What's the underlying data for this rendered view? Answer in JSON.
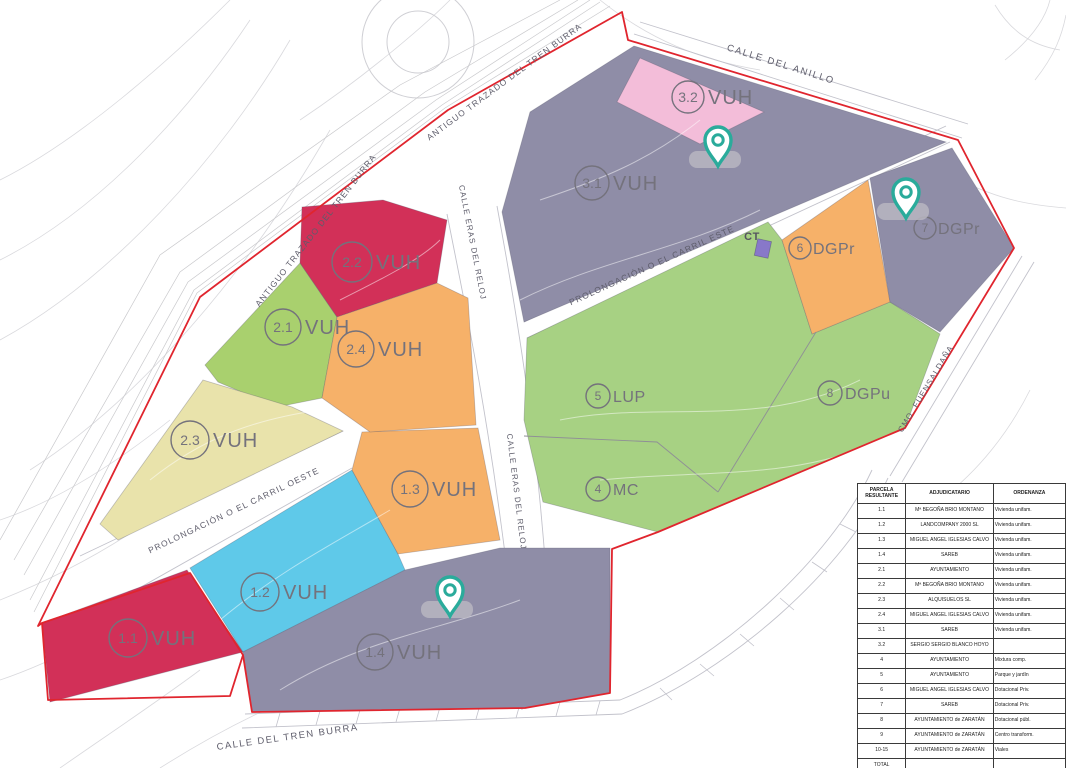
{
  "map": {
    "boundary_color": "#e0252e",
    "pin_color": "#2aab9b",
    "street_labels": [
      {
        "text": "ANTIGUO TRAZADO DEL TREN BURRA"
      },
      {
        "text": "ANTIGUO TRAZADO DEL TREN BURRA"
      },
      {
        "text": "CALLE DEL ANILLO"
      },
      {
        "text": "CALLE ERAS DEL RELOJ"
      },
      {
        "text": "CALLE ERAS DEL RELOJ"
      },
      {
        "text": "PROLONGACIÓN O EL CARRIL ESTE"
      },
      {
        "text": "PROLONGACIÓN O EL CARRIL OESTE"
      },
      {
        "text": "CALLE DEL TREN BURRA"
      },
      {
        "text": "CMO. FUENSALDAÑA"
      }
    ],
    "transformer_label": "CT",
    "parcels": [
      {
        "number": "1.1",
        "use": "VUH",
        "color": "#d23058"
      },
      {
        "number": "1.2",
        "use": "VUH",
        "color": "#5fc9e9"
      },
      {
        "number": "1.3",
        "use": "VUH",
        "color": "#f6b169"
      },
      {
        "number": "1.4",
        "use": "VUH",
        "color": "#8f8da7"
      },
      {
        "number": "2.1",
        "use": "VUH",
        "color": "#a9d06e"
      },
      {
        "number": "2.2",
        "use": "VUH",
        "color": "#d23058"
      },
      {
        "number": "2.3",
        "use": "VUH",
        "color": "#e9e3ab"
      },
      {
        "number": "2.4",
        "use": "VUH",
        "color": "#f6b169"
      },
      {
        "number": "3.1",
        "use": "VUH",
        "color": "#8f8da7"
      },
      {
        "number": "3.2",
        "use": "VUH",
        "color": "#f3bdd9"
      },
      {
        "number": "4",
        "use": "MC",
        "color": "#a7d183"
      },
      {
        "number": "5",
        "use": "LUP",
        "color": "#a7d183"
      },
      {
        "number": "6",
        "use": "DGPr",
        "color": "#f6b169"
      },
      {
        "number": "7",
        "use": "DGPr",
        "color": "#8f8da7"
      },
      {
        "number": "8",
        "use": "DGPu",
        "color": "#a7d183"
      },
      {
        "number": "9",
        "use": "CT",
        "color": "#8878c9"
      }
    ]
  },
  "table": {
    "headers": [
      "PARCELA RESULTANTE",
      "ADJUDICATARIO",
      "ORDENANZA"
    ],
    "rows": [
      {
        "parcela": "1.1",
        "adjudicatario": "Mª BEGOÑA BRIO MONTANO",
        "ordenanza": "Vivienda unifam."
      },
      {
        "parcela": "1.2",
        "adjudicatario": "LANDCOMPANY 2000 SL",
        "ordenanza": "Vivienda unifam."
      },
      {
        "parcela": "1.3",
        "adjudicatario": "MIGUEL ANGEL IGLESIAS CALVO",
        "ordenanza": "Vivienda unifam."
      },
      {
        "parcela": "1.4",
        "adjudicatario": "SAREB",
        "ordenanza": "Vivienda unifam."
      },
      {
        "parcela": "2.1",
        "adjudicatario": "AYUNTAMIENTO",
        "ordenanza": "Vivienda unifam."
      },
      {
        "parcela": "2.2",
        "adjudicatario": "Mª BEGOÑA BRIO MONTANO",
        "ordenanza": "Vivienda unifam."
      },
      {
        "parcela": "2.3",
        "adjudicatario": "ALQUISUELOS SL",
        "ordenanza": "Vivienda unifam."
      },
      {
        "parcela": "2.4",
        "adjudicatario": "MIGUEL ANGEL IGLESIAS CALVO",
        "ordenanza": "Vivienda unifam."
      },
      {
        "parcela": "3.1",
        "adjudicatario": "SAREB",
        "ordenanza": "Vivienda unifam."
      },
      {
        "parcela": "3.2",
        "adjudicatario": "SERGIO SERGIO BLANCO HOYO",
        "ordenanza": ""
      },
      {
        "parcela": "4",
        "adjudicatario": "AYUNTAMIENTO",
        "ordenanza": "Mixtura comp."
      },
      {
        "parcela": "5",
        "adjudicatario": "AYUNTAMIENTO",
        "ordenanza": "Parque y jardín"
      },
      {
        "parcela": "6",
        "adjudicatario": "MIGUEL ANGEL IGLESIAS CALVO",
        "ordenanza": "Dotacional Priv."
      },
      {
        "parcela": "7",
        "adjudicatario": "SAREB",
        "ordenanza": "Dotacional Priv."
      },
      {
        "parcela": "8",
        "adjudicatario": "AYUNTAMIENTO de ZARATÁN",
        "ordenanza": "Dotacional públ."
      },
      {
        "parcela": "9",
        "adjudicatario": "AYUNTAMIENTO de ZARATÁN",
        "ordenanza": "Centro transform."
      },
      {
        "parcela": "10-15",
        "adjudicatario": "AYUNTAMIENTO de ZARATÁN",
        "ordenanza": "Viales"
      },
      {
        "parcela": "TOTAL",
        "adjudicatario": "",
        "ordenanza": ""
      }
    ]
  }
}
